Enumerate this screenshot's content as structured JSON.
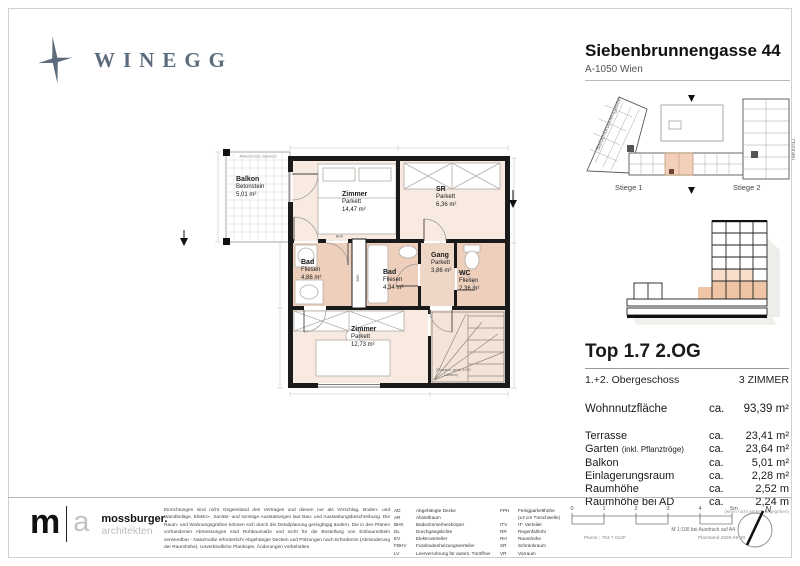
{
  "colors": {
    "brand": "#5d6b7c",
    "room_light": "#f8e9e1",
    "room_wet": "#edcfbc",
    "unit_highlight": "#f2cfb8",
    "wall": "#1a1a1a"
  },
  "brand": {
    "logo_text": "WINEGG"
  },
  "header": {
    "title": "Siebenbrunnengasse 44",
    "subtitle": "A-1050 Wien"
  },
  "site_plan": {
    "street_left": "Siebenbrunnengasse",
    "street_right": "Hoftrakt",
    "stiege_1": "Stiege 1",
    "stiege_2": "Stiege 2"
  },
  "unit_info": {
    "title": "Top 1.7 2.OG",
    "floor_label": "1.+2. Obergeschoss",
    "rooms_label": "3 ZIMMER",
    "area_label": "Wohnnutzfläche",
    "area_ca": "ca.",
    "area_value": "93,39 m²",
    "rows": [
      {
        "label": "Terrasse",
        "note": "",
        "ca": "ca.",
        "value": "23,41 m²"
      },
      {
        "label": "Garten",
        "note": "(inkl. Pflanztröge)",
        "ca": "ca.",
        "value": "23,64 m²"
      },
      {
        "label": "Balkon",
        "note": "",
        "ca": "ca.",
        "value": "5,01 m²"
      },
      {
        "label": "Einlagerungsraum",
        "note": "",
        "ca": "ca.",
        "value": "2,28 m²"
      },
      {
        "label": "Raumhöhe",
        "note": "",
        "ca": "ca.",
        "value": "2,52 m"
      },
      {
        "label": "Raumhöhe bei AD",
        "note": "",
        "ca": "ca.",
        "value": "2,24 m"
      }
    ],
    "footnote": "(wenn nicht anders angegeben)"
  },
  "plan": {
    "rooms": [
      {
        "name": "Balkon",
        "floor": "Betonstein",
        "area": "5,01 m²"
      },
      {
        "name": "Zimmer",
        "floor": "Parkett",
        "area": "14,47 m²"
      },
      {
        "name": "SR",
        "floor": "Parkett",
        "area": "6,36 m²"
      },
      {
        "name": "Bad",
        "floor": "Fliesen",
        "area": "4,86 m²"
      },
      {
        "name": "Bad",
        "floor": "Fliesen",
        "area": "4,34 m²"
      },
      {
        "name": "Gang",
        "floor": "Parkett",
        "area": "3,86 m²"
      },
      {
        "name": "WC",
        "floor": "Fliesen",
        "area": "2,36 m²"
      },
      {
        "name": "Zimmer",
        "floor": "Parkett",
        "area": "12,73 m²"
      }
    ],
    "balcony_note": "Absturzschutz raumhoch",
    "khk_label": "BHK",
    "stair_note_1": "(Stauraum, gesch. in EG",
    "stair_note_2": "Luftraum)"
  },
  "footer": {
    "architect": {
      "m": "m",
      "a": "a",
      "name": "mossburger.",
      "sub": "architekten"
    },
    "legal": "Einrichtungen sind nicht Gegenstand des Vertrages und dienen nur als Vorschlag. Boden- und Wandbeläge, Elektro-, Sanitär- und sonstige Ausstattungen laut Bau- und Ausstattungsbeschreibung. Die Raum- und Wohnungsgrößen können sich durch die Detailplanung geringfügig ändern. Die in den Plänen vorhandenen Abmessungen sind Rohbaumaße und nicht für die Bestellung von Einbaumöbeln verwendbar - Naturmaße erforderlich! Abgehängte Decken und Pölzungen nach Erfordernis (Abminderung der Raumhöhe). Unverbindliche Plankopie, Änderungen vorbehalten.",
    "legend_col1": [
      {
        "abbr": "AD",
        "desc": "Abgehängte Decke"
      },
      {
        "abbr": "AR",
        "desc": "Abstellraum"
      },
      {
        "abbr": "BHK",
        "desc": "Badezimmerheizkörper"
      },
      {
        "abbr": "DL",
        "desc": "Durchgangslichte"
      },
      {
        "abbr": "EV",
        "desc": "Elektroverteiler"
      },
      {
        "abbr": "FBHV",
        "desc": "Fussbodenheizungsverteiler"
      },
      {
        "abbr": "LV",
        "desc": "Leerverrohrung für autom. Türöffner"
      }
    ],
    "legend_col2": [
      {
        "abbr": "FPH",
        "desc": "Fertigparketthöhe"
      },
      {
        "abbr": "",
        "desc": "(±3 cm Türschwelle)"
      },
      {
        "abbr": "ITV",
        "desc": "IT- Verteiler"
      },
      {
        "abbr": "RR",
        "desc": "Regenfallrohr"
      },
      {
        "abbr": "RH",
        "desc": "Raumhöhe"
      },
      {
        "abbr": "SR",
        "desc": "Schrankraum"
      },
      {
        "abbr": "VR",
        "desc": "Vorraum"
      }
    ],
    "scale": {
      "ticks": [
        "0",
        "1",
        "2",
        "3",
        "4",
        "5m"
      ],
      "note": "M 1:100 bei Ausdruck auf A4",
      "plan_no": "Plannr.: 763 7 012F",
      "plan_date": "Planstand 2025-05-30"
    },
    "north_label": "N"
  }
}
